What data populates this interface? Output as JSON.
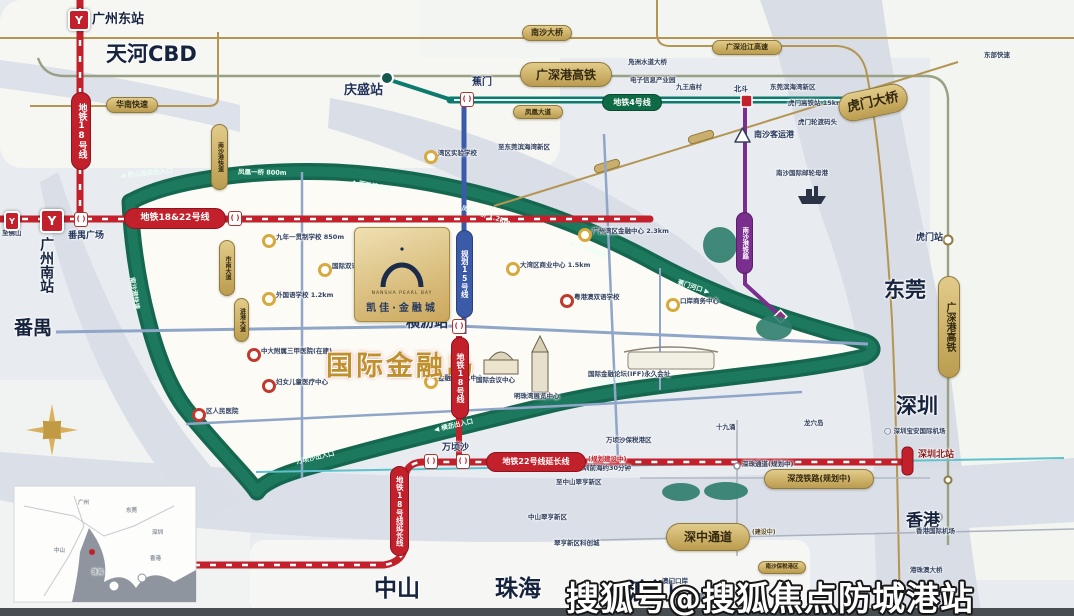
{
  "title": {
    "main": "国际金融岛"
  },
  "watermark": "搜狐号@搜狐焦点防城港站",
  "card": {
    "sub": "NANSHA PEARL BAY",
    "name": "凯佳·金融城"
  },
  "cities": {
    "gz_east": "广州东站",
    "tianhe": "天河CBD",
    "panyu_square": "番禺广场",
    "gz_south": "广州南站",
    "panyu": "番禺",
    "dongguan": "东莞",
    "shenzhen": "深圳",
    "zhongshan": "中山",
    "zhuhai": "珠海",
    "macau": "澳门",
    "hongkong": "香港"
  },
  "stations": {
    "qingsheng": "庆盛站",
    "jiaomen": "蕉门",
    "hengli": "横沥站",
    "wanqingsha": "万顷沙",
    "humen": "虎门站",
    "shenzhen_north": "深圳北站",
    "beidou": "北斗",
    "nansha_port": "南沙客运港"
  },
  "metro": {
    "m1822": "地铁18&22号线",
    "m18": "地铁18号线",
    "m22_ext": "地铁22号线延长线",
    "m22_note": "(规划建设中)",
    "m18_ext": "地铁18号线延长线",
    "m18_south": "地铁18号线",
    "line15": "规划15号线",
    "line4": "地铁4号线",
    "ns_rail": "南沙港铁路"
  },
  "roads": {
    "gsg_hsr": "广深港高铁",
    "gsg_hsr_v": "广深港高铁",
    "nansha_bridge": "南沙大桥",
    "yanjiang": "广深沿江高速",
    "huanan": "华南快速",
    "humen_bridge": "虎门大桥",
    "szt": "深中通道",
    "szt_sub": "(建设中)",
    "shenmao": "深茂铁路(规划中)",
    "bonded": "南沙保税港区",
    "fenghuang": "凤凰大道",
    "shinan": "市南大道",
    "jingang": "进港大道",
    "nsg_exp": "南沙港快速"
  },
  "ring": {
    "r1": "◀ 灵山岛尖出入口",
    "r2": "凤凰一桥 800m",
    "r3": "◆ 明珠湾大桥",
    "r4": "凤凰三桥 1.2km",
    "r5": "◆ 灵山岛隧道",
    "r6": "蕉门河口 ▶",
    "r7": "明珠湾起步区",
    "r8": "◀ 横沥出入口",
    "r9": "万顷沙出入口",
    "r10": "南沙港快速"
  },
  "pois": [
    {
      "label": "九年一贯制学校 850m"
    },
    {
      "label": "国际双语幼儿园"
    },
    {
      "label": "外国语学校 1.2km"
    },
    {
      "label": "中大附属三甲医院(在建)"
    },
    {
      "label": "妇女儿童医疗中心"
    },
    {
      "label": "湾区实验学校"
    },
    {
      "label": "大湾区商业中心 1.5km"
    },
    {
      "label": "广州湾区金融中心 2.3km"
    },
    {
      "label": "粤港澳双语学校"
    },
    {
      "label": "口岸商务中心"
    },
    {
      "label": "金融岛展示中心"
    },
    {
      "label": "区人民医院"
    }
  ],
  "landmarks": {
    "dome": "国际会议中心",
    "tower": "明珠湾展览中心",
    "iff": "国际金融论坛(IFF)永久会址",
    "cruise": "南沙国际邮轮母港"
  },
  "notes": [
    {
      "t": "东部快速"
    },
    {
      "t": "东莞滨海湾新区"
    },
    {
      "t": "虎门高铁站 15km"
    },
    {
      "t": "虎门轮渡码头"
    },
    {
      "t": "凫洲水道大桥"
    },
    {
      "t": "电子信息产业园"
    },
    {
      "t": "九王庙村"
    },
    {
      "t": "至东莞滨海湾新区"
    },
    {
      "t": "十九涌"
    },
    {
      "t": "龙穴岛"
    },
    {
      "t": "万顷沙保税港区"
    },
    {
      "t": "至深圳前海约30分钟"
    },
    {
      "t": "至中山翠亨新区"
    },
    {
      "t": "中山翠亨新区"
    },
    {
      "t": "翠亨新区科创城"
    },
    {
      "t": "◯ 深圳宝安国际机场"
    },
    {
      "t": "香港国际机场"
    },
    {
      "t": "港珠澳大桥"
    },
    {
      "t": "澳门口岸"
    },
    {
      "t": "◯ 澳门国际机场"
    },
    {
      "t": "至佛山"
    },
    {
      "t": "深珠通道(规划中)"
    }
  ],
  "inset": {
    "gz": "广州",
    "dg": "东莞",
    "sz": "深圳",
    "zs": "中山",
    "zh": "珠海",
    "hk": "香港"
  }
}
